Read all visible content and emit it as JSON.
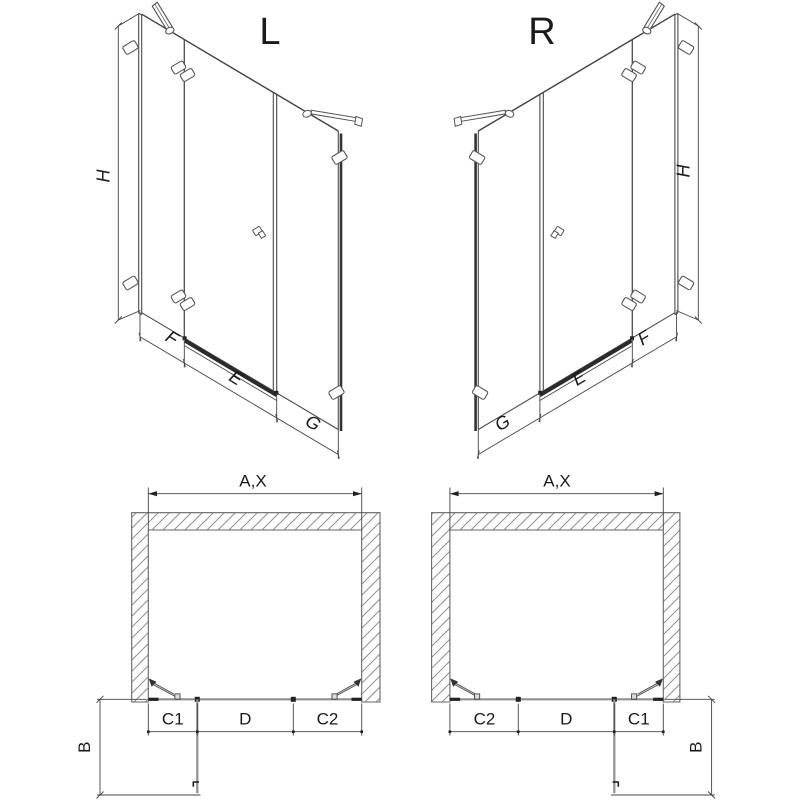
{
  "figures": {
    "iso_left": {
      "title": "L",
      "height_label": "H",
      "bottom_labels": [
        "F",
        "E",
        "G"
      ]
    },
    "iso_right": {
      "title": "R",
      "height_label": "H",
      "bottom_labels": [
        "G",
        "E",
        "F"
      ]
    },
    "plan_left": {
      "width_label": "A,X",
      "segment_labels": [
        "C1",
        "D",
        "C2"
      ],
      "depth_label": "B"
    },
    "plan_right": {
      "width_label": "A,X",
      "segment_labels": [
        "C2",
        "D",
        "C1"
      ],
      "depth_label": "B"
    }
  },
  "colors": {
    "line": "#444444",
    "glass": "#8f8f8f",
    "dark": "#222222",
    "hatch": "#909090",
    "background": "#ffffff"
  }
}
